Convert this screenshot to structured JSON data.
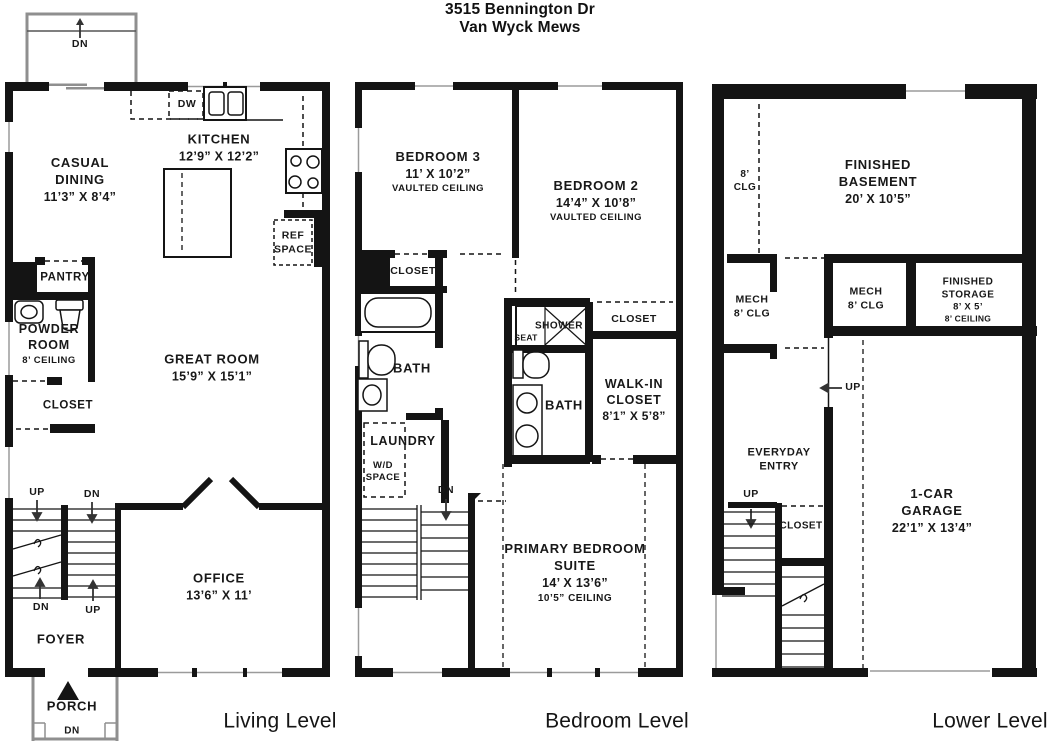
{
  "title": {
    "line1": "3515 Bennington Dr",
    "line2": "Van Wyck Mews"
  },
  "wall_color": "#141414",
  "levels": {
    "living": {
      "caption": "Living Level",
      "deck": {
        "dn": "DN"
      },
      "porch": {
        "name": "PORCH",
        "dn": "DN"
      },
      "stairs": {
        "up_top": "UP",
        "dn_top": "DN",
        "dn_bottom": "DN",
        "up_bottom": "UP"
      },
      "rooms": {
        "casual_dining": {
          "name": "CASUAL DINING",
          "dims": "11’3” X 8’4”"
        },
        "kitchen": {
          "name": "KITCHEN",
          "dims": "12’9” X 12’2”"
        },
        "dw": {
          "name": "DW"
        },
        "ref_space": {
          "name": "REF SPACE"
        },
        "pantry": {
          "name": "PANTRY"
        },
        "powder_room": {
          "name": "POWDER ROOM",
          "note": "8’ CEILING"
        },
        "closet": {
          "name": "CLOSET"
        },
        "great_room": {
          "name": "GREAT ROOM",
          "dims": "15’9” X 15’1”"
        },
        "office": {
          "name": "OFFICE",
          "dims": "13’6” X 11’"
        },
        "foyer": {
          "name": "FOYER"
        }
      }
    },
    "bedroom": {
      "caption": "Bedroom Level",
      "stairs": {
        "dn": "DN"
      },
      "rooms": {
        "bedroom3": {
          "name": "BEDROOM 3",
          "dims": "11’ X 10’2”",
          "note": "VAULTED CEILING"
        },
        "bedroom2": {
          "name": "BEDROOM 2",
          "dims": "14’4” X 10’8”",
          "note": "VAULTED CEILING"
        },
        "closet_bed3": {
          "name": "CLOSET"
        },
        "hall_bath": {
          "name": "BATH"
        },
        "laundry": {
          "name": "LAUNDRY",
          "note": "W/D SPACE"
        },
        "shower": {
          "name": "SHOWER",
          "seat": "SEAT"
        },
        "closet_bed2": {
          "name": "CLOSET"
        },
        "primary_bath": {
          "name": "BATH"
        },
        "walk_in_closet": {
          "name": "WALK-IN CLOSET",
          "dims": "8’1” X 5’8”"
        },
        "primary_suite": {
          "name": "PRIMARY BEDROOM SUITE",
          "dims": "14’ X 13’6”",
          "note": "10’5” CEILING"
        }
      }
    },
    "lower": {
      "caption": "Lower Level",
      "stairs": {
        "up": "UP"
      },
      "hall": {
        "up": "UP"
      },
      "rooms": {
        "ceiling_break": {
          "name": "8’ CLG"
        },
        "finished_basement": {
          "name": "FINISHED BASEMENT",
          "dims": "20’ X 10’5”"
        },
        "mech_left": {
          "name": "MECH",
          "note": "8’ CLG"
        },
        "mech_mid": {
          "name": "MECH",
          "note": "8’ CLG"
        },
        "finished_storage": {
          "name": "FINISHED STORAGE",
          "dims": "8’ X 5’",
          "note": "8’ CEILING"
        },
        "everyday_entry": {
          "name": "EVERYDAY ENTRY"
        },
        "closet": {
          "name": "CLOSET"
        },
        "garage": {
          "name": "1-CAR GARAGE",
          "dims": "22’1” X 13’4”"
        }
      }
    }
  }
}
